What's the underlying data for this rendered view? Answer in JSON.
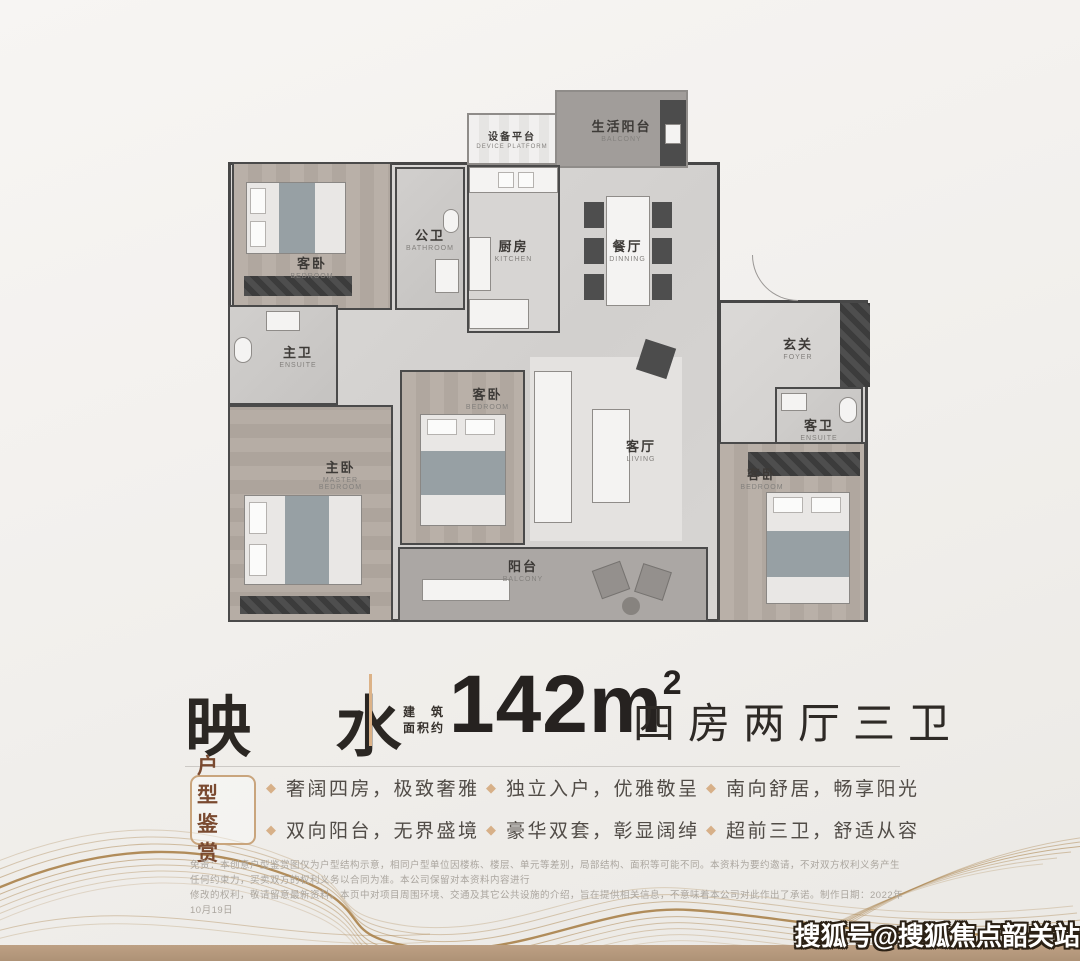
{
  "floor_plan": {
    "rooms": [
      {
        "id": "device-platform",
        "zh": "设备平台",
        "en": "DEVICE PLATFORM"
      },
      {
        "id": "life-balcony",
        "zh": "生活阳台",
        "en": "BALCONY"
      },
      {
        "id": "bedroom-north",
        "zh": "客卧",
        "en": "BEDROOM"
      },
      {
        "id": "public-bathroom",
        "zh": "公卫",
        "en": "BATHROOM"
      },
      {
        "id": "kitchen",
        "zh": "厨房",
        "en": "KITCHEN"
      },
      {
        "id": "dining",
        "zh": "餐厅",
        "en": "DINNING"
      },
      {
        "id": "foyer",
        "zh": "玄关",
        "en": "FOYER"
      },
      {
        "id": "master-ensuite",
        "zh": "主卫",
        "en": "ENSUITE"
      },
      {
        "id": "master-bedroom",
        "zh": "主卧",
        "en": "MASTER BEDROOM"
      },
      {
        "id": "bedroom-center",
        "zh": "客卧",
        "en": "BEDROOM"
      },
      {
        "id": "living",
        "zh": "客厅",
        "en": "LIVING"
      },
      {
        "id": "guest-ensuite",
        "zh": "客卫",
        "en": "ENSUITE"
      },
      {
        "id": "bedroom-south",
        "zh": "客卧",
        "en": "BEDROOM"
      },
      {
        "id": "balcony-south",
        "zh": "阳台",
        "en": "BALCONY"
      }
    ]
  },
  "title": {
    "name": "映 水",
    "area_prefix_line1": "建 筑",
    "area_prefix_line2": "面积约",
    "area_value": "142m",
    "area_sup": "2",
    "layout": "四房两厅三卫"
  },
  "features": {
    "badge_line1": "户 型",
    "badge_line2": "鉴 赏",
    "bullet": "◆",
    "columns": [
      {
        "items": [
          "奢阔四房，极致奢雅",
          "双向阳台，无界盛境"
        ]
      },
      {
        "items": [
          "独立入户，优雅敬呈",
          "豪华双套，彰显阔绰"
        ]
      },
      {
        "items": [
          "南向舒居，畅享阳光",
          "超前三卫，舒适从容"
        ]
      }
    ]
  },
  "disclaimer": {
    "line1": "免责：本创意户型鉴赏图仅为户型结构示意，相同户型单位因楼栋、楼层、单元等差别，局部结构、面积等可能不同。本资料为要约邀请，不对双方权利义务产生任何约束力，买卖双方的权利义务以合同为准。本公司保留对本资料内容进行",
    "line2": "修改的权利，敬请留意最新资料。本页中对项目周围环境、交通及其它公共设施的介绍，旨在提供相关信息，不意味着本公司对此作出了承诺。制作日期：2022年10月19日"
  },
  "watermark": "搜狐号@搜狐焦点韶关站",
  "colors": {
    "accent_gold": "#c9a57d",
    "badge_text": "#7a4a30",
    "diamond_bullet": "#d7b088",
    "wall": "#474747",
    "bottom_bar": "#b39877",
    "title_text": "#2b2723",
    "disclaimer_text": "#aba69f"
  }
}
